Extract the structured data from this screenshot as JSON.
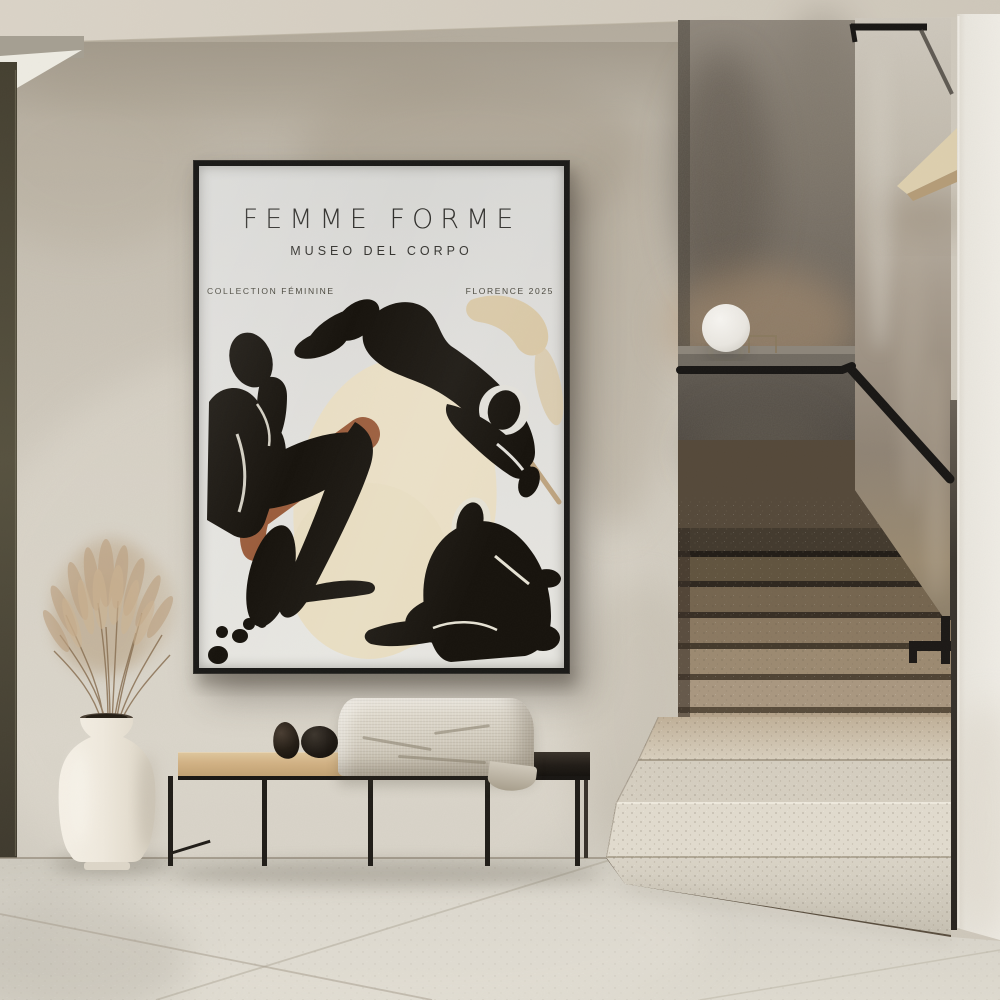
{
  "poster": {
    "title": "FEMME FORME",
    "subtitle": "MUSEO DEL CORPO",
    "label_left": "COLLECTION FÉMININE",
    "label_right": "FLORENCE 2025"
  },
  "palette": {
    "wall": "#cdc6ba",
    "ceiling": "#d6cfc3",
    "door_frame": "#4c4737",
    "poster_frame": "#1b1a18",
    "poster_background": "#e2e1dd",
    "poster_cream_blob": "#eadfc5",
    "poster_terracotta": "#9b5d3c",
    "figure_black": "#17130d",
    "stairwell_wall": "#6e665c",
    "ledge": "#716b62",
    "handrail": "#191715",
    "stair_tread_upper": "#8a7961",
    "stair_tread_lower": "#e1dbce",
    "side_wall": "#a89d8f",
    "accent_wall": "#ece9e1",
    "wood_shelf": "#ddcfae",
    "floor": "#d8d4ca",
    "bench_wood": "#d2b285",
    "bench_dark_wood": "#211c17",
    "bench_frame": "#201d18",
    "pebbles": "#1d1813",
    "blanket": "#d9d3c6",
    "vase": "#efe9dd",
    "pampas": "#b49a76",
    "lamp": "#edebe6"
  }
}
